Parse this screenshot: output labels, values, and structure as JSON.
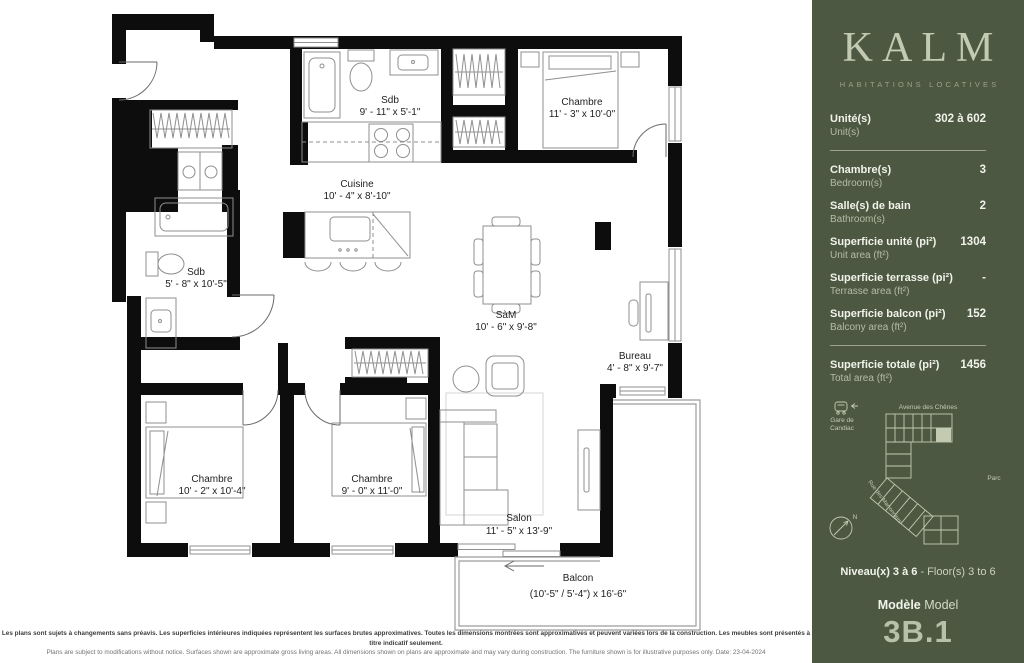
{
  "theme_note": "colors duplicated as CSS vars",
  "colors": {
    "sidebar_background": "#4d5843",
    "sidebar_text": "#f1f3ea",
    "sidebar_accent": "#c3cab2",
    "model_code": "#b8c1a8",
    "plan_walls": "#0d0d0d"
  },
  "sidebar": {
    "brand": {
      "name": "KALM",
      "tagline": "HABITATIONS LOCATIVES"
    },
    "rows": [
      {
        "fr": "Unité(s)",
        "en": "Unit(s)",
        "value": "302 à 602"
      },
      {
        "fr": "Chambre(s)",
        "en": "Bedroom(s)",
        "value": "3"
      },
      {
        "fr": "Salle(s) de bain",
        "en": "Bathroom(s)",
        "value": "2"
      },
      {
        "fr": "Superficie unité (pi²)",
        "en": "Unit area (ft²)",
        "value": "1304"
      },
      {
        "fr": "Superficie terrasse (pi²)",
        "en": "Terrasse area (ft²)",
        "value": "-"
      },
      {
        "fr": "Superficie balcon (pi²)",
        "en": "Balcony area (ft²)",
        "value": "152"
      },
      {
        "fr": "Superficie totale (pi²)",
        "en": "Total area (ft²)",
        "value": "1456"
      }
    ],
    "map": {
      "street_top": "Avenue des Chênes",
      "street_diagonal": "Rue des Marronniers",
      "park": "Parc",
      "station": [
        "Gare de",
        "Candiac"
      ],
      "compass": "N"
    },
    "floors": {
      "fr": "Niveau(x) 3 à 6",
      "en": " - Floor(s) 3 to 6"
    },
    "model": {
      "fr": "Modèle",
      "en": " Model",
      "code": "3B.1"
    }
  },
  "plan": {
    "rooms": {
      "sdb_top": {
        "name": "Sdb",
        "dims": "9' - 11\" x 5'-1\""
      },
      "chambre_tr": {
        "name": "Chambre",
        "dims": "11' - 3\" x 10'-0\""
      },
      "cuisine": {
        "name": "Cuisine",
        "dims": "10' - 4\" x 8'-10\""
      },
      "sdb_left": {
        "name": "Sdb",
        "dims": "5' - 8\" x 10'-5\""
      },
      "sam": {
        "name": "SàM",
        "dims": "10' - 6\" x 9'-8\""
      },
      "bureau": {
        "name": "Bureau",
        "dims": "4' - 8\" x 9'-7\""
      },
      "chambre_bl": {
        "name": "Chambre",
        "dims": "10' - 2\" x 10'-4\""
      },
      "chambre_bm": {
        "name": "Chambre",
        "dims": "9' - 0\" x 11'-0\""
      },
      "salon": {
        "name": "Salon",
        "dims": "11' - 5\" x 13'-9\""
      },
      "balcon": {
        "name": "Balcon",
        "dims": "(10'-5\" / 5'-4\") x 16'-6\""
      }
    }
  },
  "footer": {
    "fr": "Les plans sont sujets à changements sans préavis. Les superficies intérieures indiquées représentent les surfaces brutes approximatives. Toutes les dimensions montrées sont approximatives et peuvent variées lors de la construction. Les meubles sont présentés à titre indicatif seulement.",
    "en": "Plans are subject to modifications without notice. Surfaces shown are approximate gross living areas. All dimensions shown on plans are approximate and may vary during construction. The furniture shown is for illustrative purposes only. Date: 23-04-2024"
  }
}
